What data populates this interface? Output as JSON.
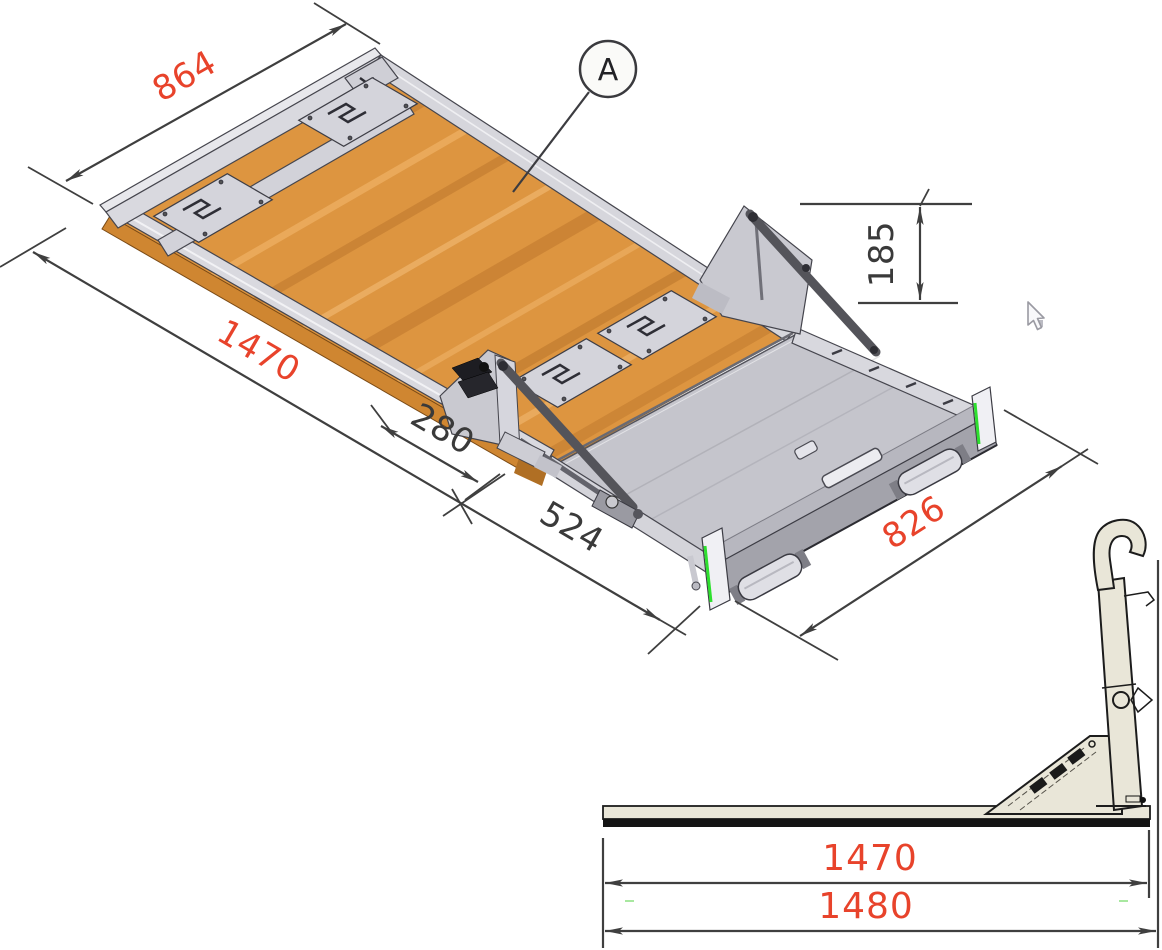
{
  "drawing": {
    "background": "#ffffff",
    "balloon": {
      "label": "A"
    },
    "dims": {
      "d864": {
        "value": "864"
      },
      "d1470_iso": {
        "value": "1470"
      },
      "d280": {
        "value": "280"
      },
      "d524": {
        "value": "524"
      },
      "d826": {
        "value": "826"
      },
      "d185": {
        "value": "185"
      },
      "d1470_side": {
        "value": "1470"
      },
      "d1480": {
        "value": "1480"
      }
    },
    "colors": {
      "accent": "#e8432b",
      "dark": "#3a3a3a",
      "wood": "#dd9540",
      "wood_rim": "#cf8631",
      "metal_light": "#d9d9df",
      "platform_gray": "#c5c5cc",
      "arm_dark": "#54545a",
      "side_body": "#e9e6d8",
      "highlight_green": "#2ee02e"
    },
    "icons": {
      "cursor": "arrow-cursor"
    }
  }
}
